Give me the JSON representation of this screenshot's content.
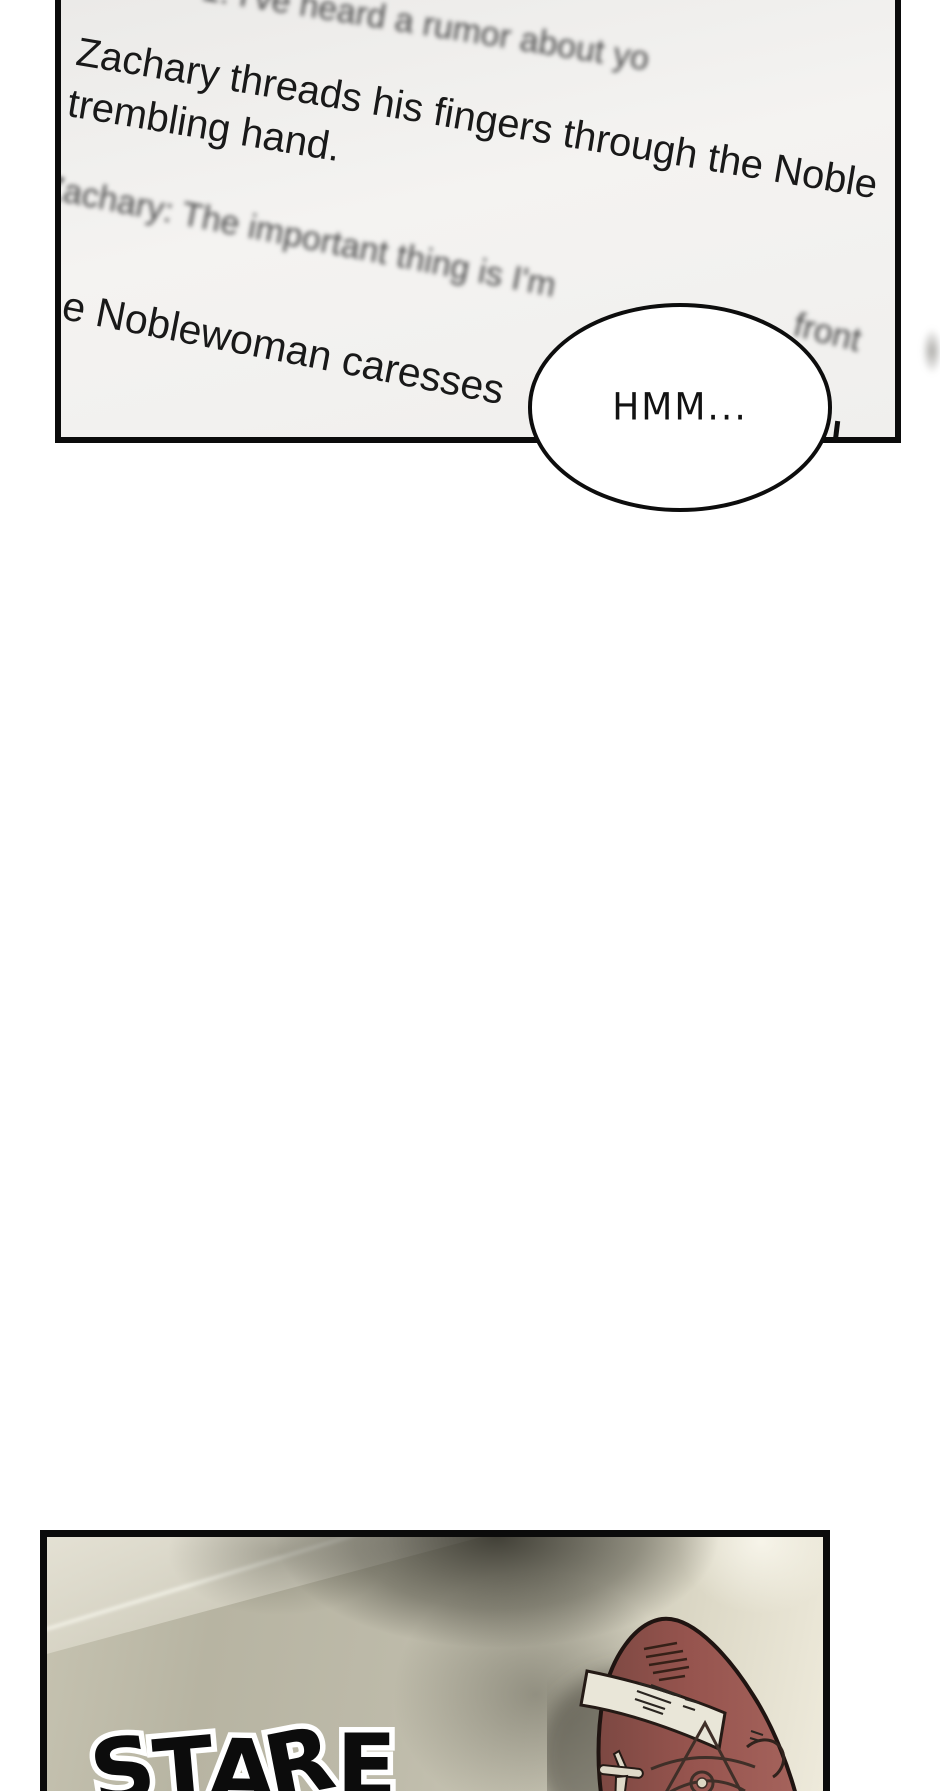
{
  "comic": {
    "panel_screen": {
      "rumor_line_blurred": "1: I've heard a rumor about yo",
      "narration_zachary_line1": "Zachary threads his fingers through the Noble",
      "narration_zachary_line2": "trembling hand.",
      "zachary_dialogue_blurred": "Zachary: The important thing is I'm",
      "fragment_front_blurred": "front",
      "narration_noblewoman": "he Noblewoman caresses",
      "speech_bubble": "HMM..."
    },
    "panel_floor": {
      "sfx": "STARE"
    },
    "colors": {
      "panel_border": "#0b0b0b",
      "screen_background": "#f1f0ee",
      "floor_base": "#bdbaa9",
      "floor_highlight": "#eeeadb",
      "floor_shadow": "#3a392e",
      "shoe_red": "#9a5a55",
      "shoe_red_dark": "#7c4842",
      "shoe_band": "#e9e6d8",
      "shoe_outline": "#1f1411",
      "sfx_fill": "#0c0c0c",
      "sfx_outline": "#ffffff",
      "bubble_fill": "#ffffff",
      "bubble_stroke": "#0d0d0d"
    }
  }
}
